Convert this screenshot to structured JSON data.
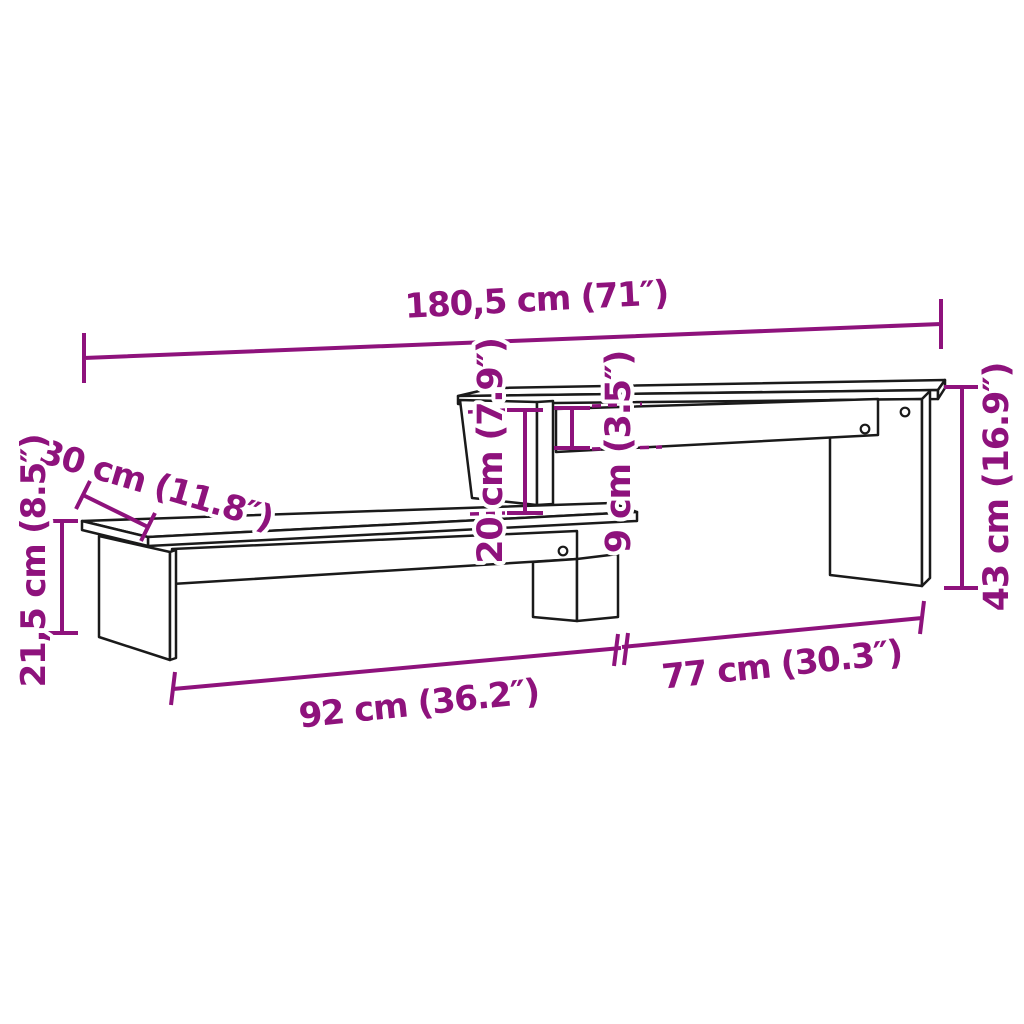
{
  "diagram": {
    "kind": "product-dimension-diagram",
    "subject": "two-tier TV stand line drawing",
    "background_color": "#ffffff",
    "outline_color": "#1a1a1a",
    "dimension_color": "#8E127C",
    "screw_hole_count": 3,
    "parts": [
      "upper-shelf",
      "right-side-panel",
      "upper-back-rail",
      "middle-divider",
      "lower-shelf",
      "lower-back-rail",
      "middle-leg",
      "left-side-panel"
    ],
    "dimensions": {
      "total_width": "180,5 cm (71″)",
      "depth": "30 cm (11.8″)",
      "left_height": "21,5 cm (8.5″)",
      "shelf_gap": "20 cm (7.9″)",
      "rail_height": "9 cm (3.5″)",
      "right_height": "43 cm (16.9″)",
      "lower_length": "92 cm (36.2″)",
      "upper_length": "77 cm (30.3″)"
    }
  }
}
